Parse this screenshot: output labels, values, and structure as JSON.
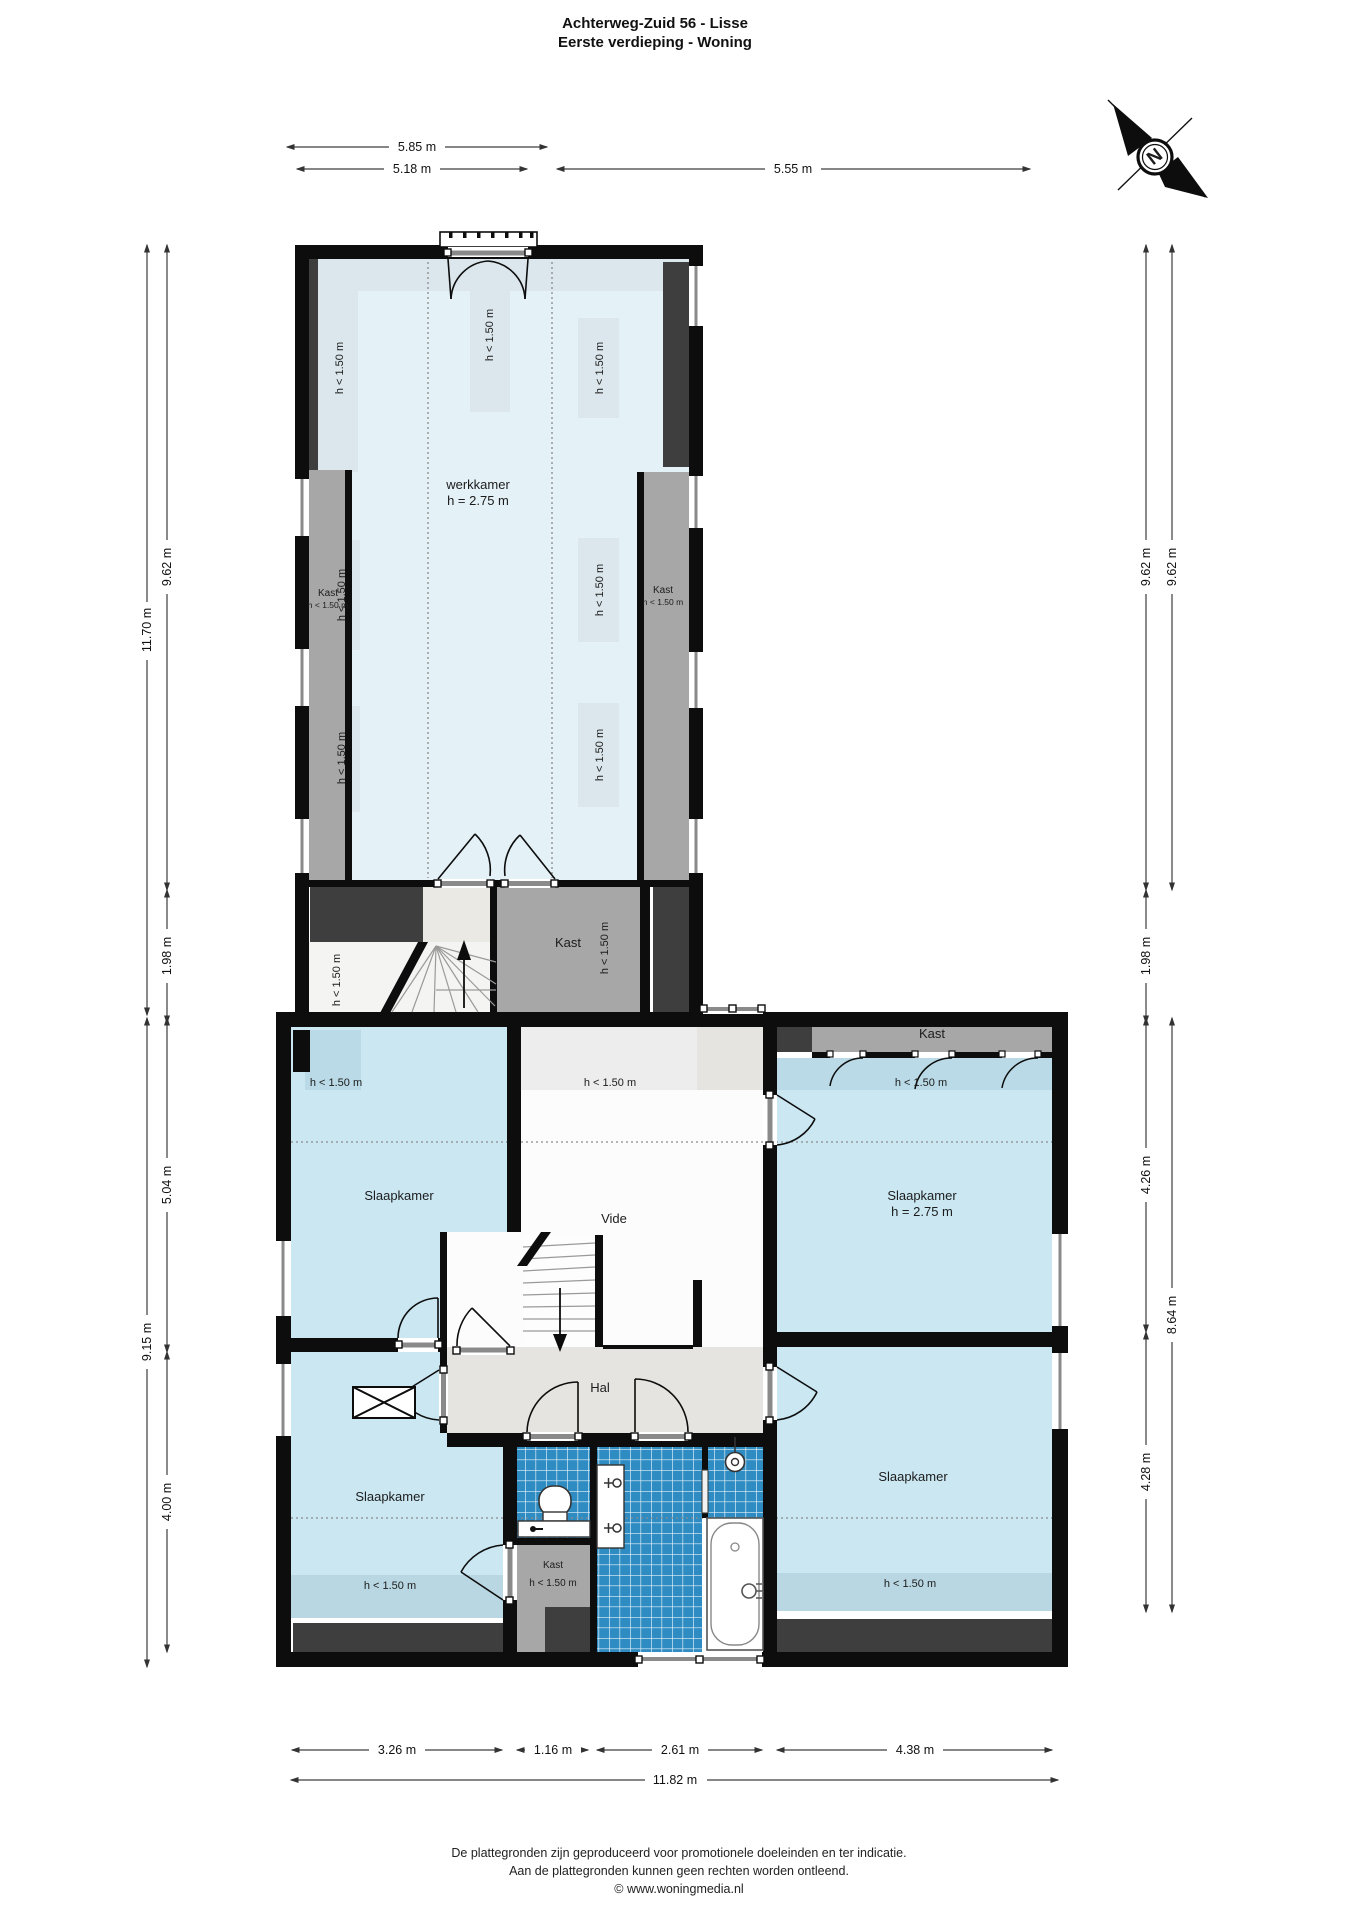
{
  "title": {
    "line1": "Achterweg-Zuid 56 - Lisse",
    "line2": "Eerste verdieping - Woning"
  },
  "compass": {
    "letter": "N"
  },
  "labels": {
    "low_height": "h < 1.50 m"
  },
  "rooms": {
    "werkkamer": {
      "name": "werkkamer",
      "height": "h = 2.75 m"
    },
    "kast_wing_left": {
      "name": "Kast",
      "height": "h < 1.50 m"
    },
    "kast_wing_right": {
      "name": "Kast",
      "height": "h < 1.50 m"
    },
    "kast_landing": {
      "name": "Kast"
    },
    "kast_top_right": {
      "name": "Kast"
    },
    "kast_bathroom": {
      "name": "Kast",
      "height": "h < 1.50 m"
    },
    "slaapkamer_top_left": {
      "name": "Slaapkamer"
    },
    "slaapkamer_top_right": {
      "name": "Slaapkamer",
      "height": "h = 2.75 m"
    },
    "slaapkamer_bottom_left": {
      "name": "Slaapkamer"
    },
    "slaapkamer_bottom_right": {
      "name": "Slaapkamer"
    },
    "vide": {
      "name": "Vide"
    },
    "hal": {
      "name": "Hal"
    }
  },
  "dimensions": {
    "top": [
      {
        "label": "5.85 m"
      },
      {
        "label": "5.18 m"
      },
      {
        "label": "5.55 m"
      }
    ],
    "left": [
      {
        "label": "11.70 m"
      },
      {
        "label": "9.62 m"
      },
      {
        "label": "1.98 m"
      },
      {
        "label": "9.15 m"
      },
      {
        "label": "5.04 m"
      },
      {
        "label": "4.00 m"
      }
    ],
    "right": [
      {
        "label": "9.62 m"
      },
      {
        "label": "9.62 m"
      },
      {
        "label": "1.98 m"
      },
      {
        "label": "4.26 m"
      },
      {
        "label": "8.64 m"
      },
      {
        "label": "4.28 m"
      }
    ],
    "bottom": [
      {
        "label": "3.26 m"
      },
      {
        "label": "1.16 m"
      },
      {
        "label": "2.61 m"
      },
      {
        "label": "4.38 m"
      },
      {
        "label": "11.82 m"
      }
    ]
  },
  "footer": {
    "line1": "De plattegronden zijn geproduceerd voor promotionele doeleinden en ter indicatie.",
    "line2": "Aan de plattegronden kunnen geen rechten worden ontleend.",
    "line3": "© www.woningmedia.nl"
  }
}
